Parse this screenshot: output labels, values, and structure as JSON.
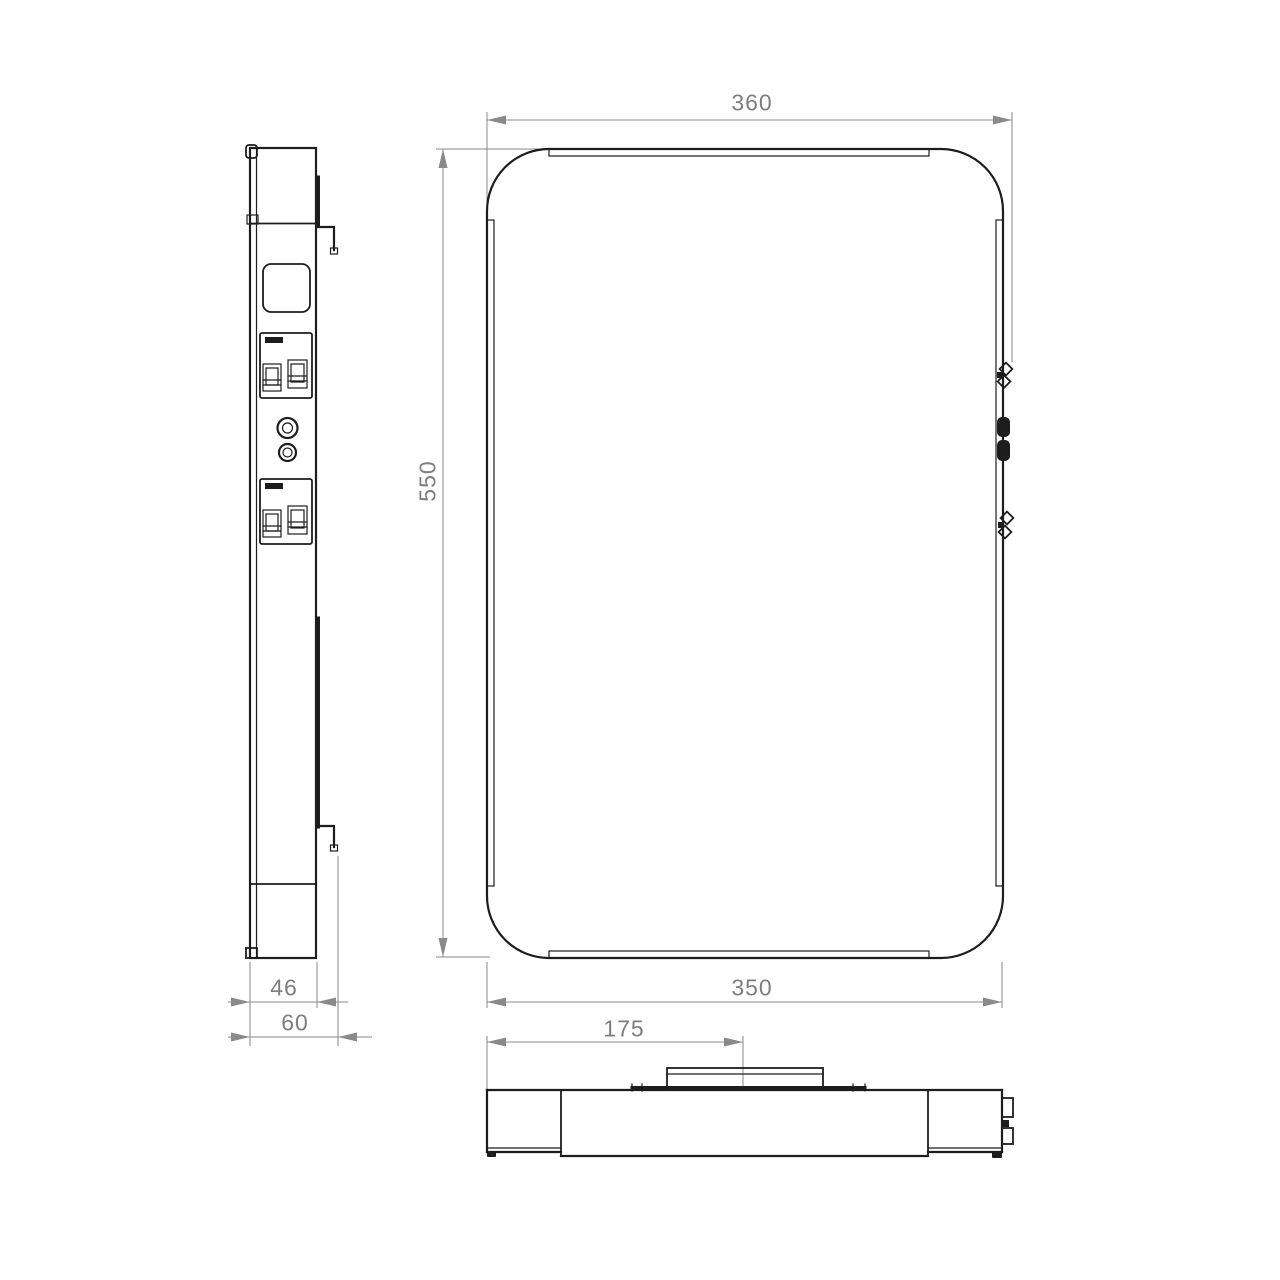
{
  "drawing": {
    "type": "technical-dimension-drawing",
    "background": "#ffffff",
    "palette": {
      "line": "#1d1d1d",
      "dim_line": "#8a8a8a",
      "dim_text": "#7e7e7e"
    },
    "views": [
      "side-view",
      "front-view",
      "bottom-view"
    ],
    "dimensions": {
      "overall_width": "360",
      "panel_height": "550",
      "panel_width": "350",
      "bracket_offset": "175",
      "panel_depth": "46",
      "overall_depth": "60"
    }
  }
}
